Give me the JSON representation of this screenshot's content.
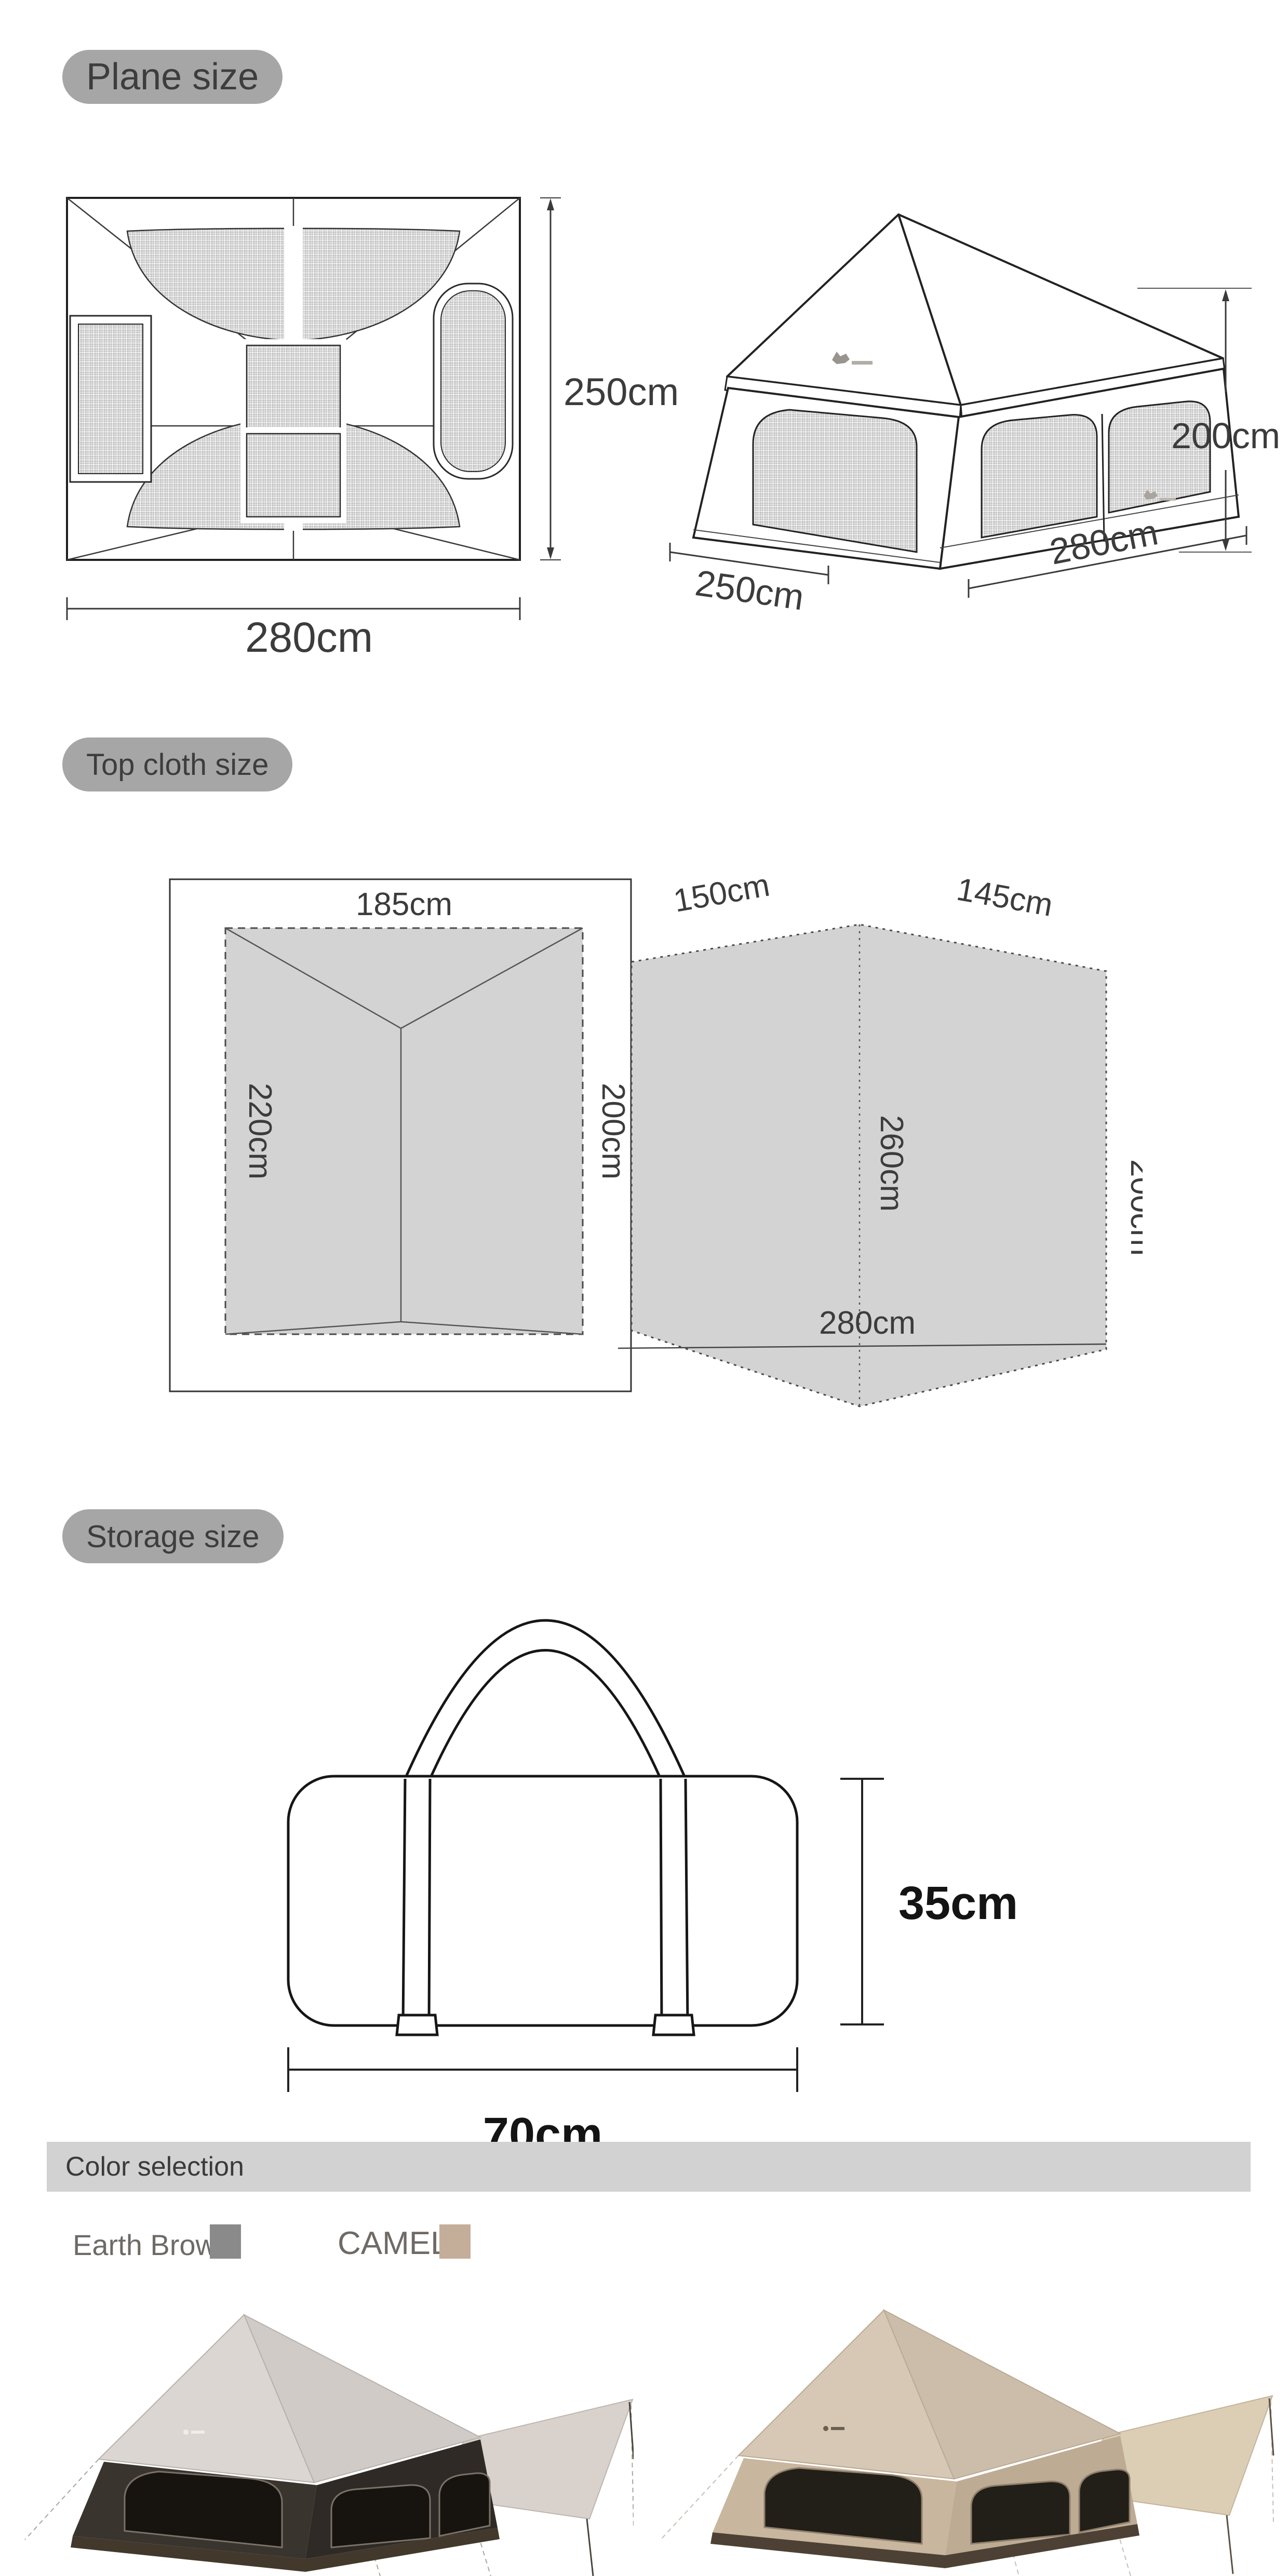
{
  "badges": {
    "plane": "Plane size",
    "top_cloth": "Top cloth size",
    "storage": "Storage size"
  },
  "plane_size": {
    "top_view": {
      "height": "250cm",
      "width": "280cm"
    },
    "perspective": {
      "height": "200cm",
      "side": "250cm",
      "front": "280cm"
    }
  },
  "top_cloth_size": {
    "inner_panel": {
      "top_edge": "185cm",
      "left_edge": "220cm",
      "right_edge": "200cm"
    },
    "outer_panel": {
      "top_left_edge": "150cm",
      "top_right_edge": "145cm",
      "center_fold": "260cm",
      "right_edge": "200cm",
      "bottom_edge": "280cm"
    }
  },
  "storage_size": {
    "height": "35cm",
    "width": "70cm"
  },
  "color_selection": {
    "title": "Color selection",
    "options": [
      {
        "label": "Earth Brown",
        "swatch_color": "#8a8a8a"
      },
      {
        "label": "CAMEL",
        "swatch_color": "#c4ae9a"
      }
    ]
  },
  "colors": {
    "badge_bg": "#a6a6a6",
    "diagram_fill": "#d3d3d3",
    "banner_bg": "#d2d2d2",
    "dimension_text": "#3c3c3c"
  }
}
